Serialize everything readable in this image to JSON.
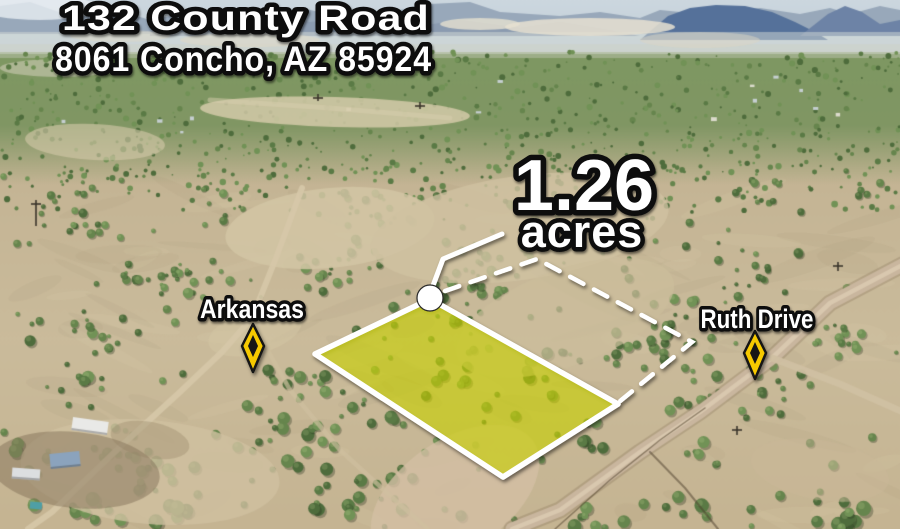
{
  "listing": {
    "address_line1": "132 County Road",
    "address_line2": "8061 Concho, AZ 85924",
    "acreage_value": "1.26",
    "acreage_unit": "acres"
  },
  "map": {
    "street_label_left": "Arkansas",
    "street_label_right": "Ruth Drive"
  },
  "colors": {
    "parcel_fill": "#dce600",
    "parcel_border": "#ffffff",
    "boundary_dash": "#ffffff",
    "marker_yellow": "#f6c900",
    "marker_outline": "#131313",
    "text_fill": "#ffffff",
    "text_outline": "#0a0a0a"
  }
}
